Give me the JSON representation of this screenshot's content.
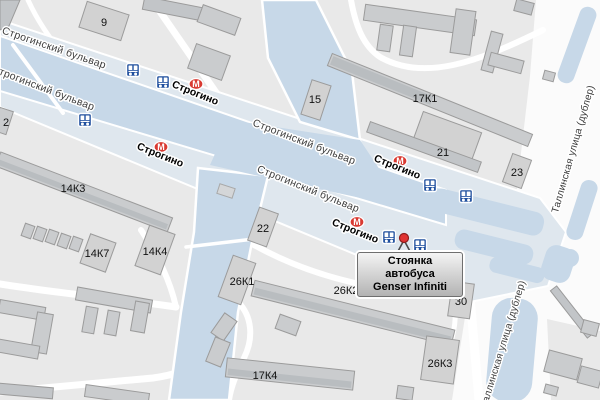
{
  "labels": {
    "boulevard": "Строгинский бульвар",
    "tallinn_street": "Таллинская улица (дублер)",
    "metro_station": "Строгино",
    "metro_letter": "М"
  },
  "buildings": {
    "b9": "9",
    "b15": "15",
    "b17k1": "17К1",
    "b21": "21",
    "b23": "23",
    "b2": "2",
    "b14k3": "14К3",
    "b14k7": "14К7",
    "b14k4": "14К4",
    "b22": "22",
    "b26k1": "26К1",
    "b26k2": "26К2",
    "b30": "30",
    "b26k3": "26К3",
    "b17k4": "17К4"
  },
  "callout": {
    "line1": "Стоянка автобуса",
    "line2": "Genser Infiniti"
  },
  "colors": {
    "land": "#e9e9e9",
    "road_white": "#fbfbfb",
    "road_blue": "#c7d8e8",
    "road_pale": "#dfe7ee",
    "building_fill": "#d2d2d2",
    "building_stroke": "#9b9b9b",
    "metro_red": "#d93a32",
    "bus_blue": "#1f4f9e",
    "marker_red": "#e03232"
  }
}
